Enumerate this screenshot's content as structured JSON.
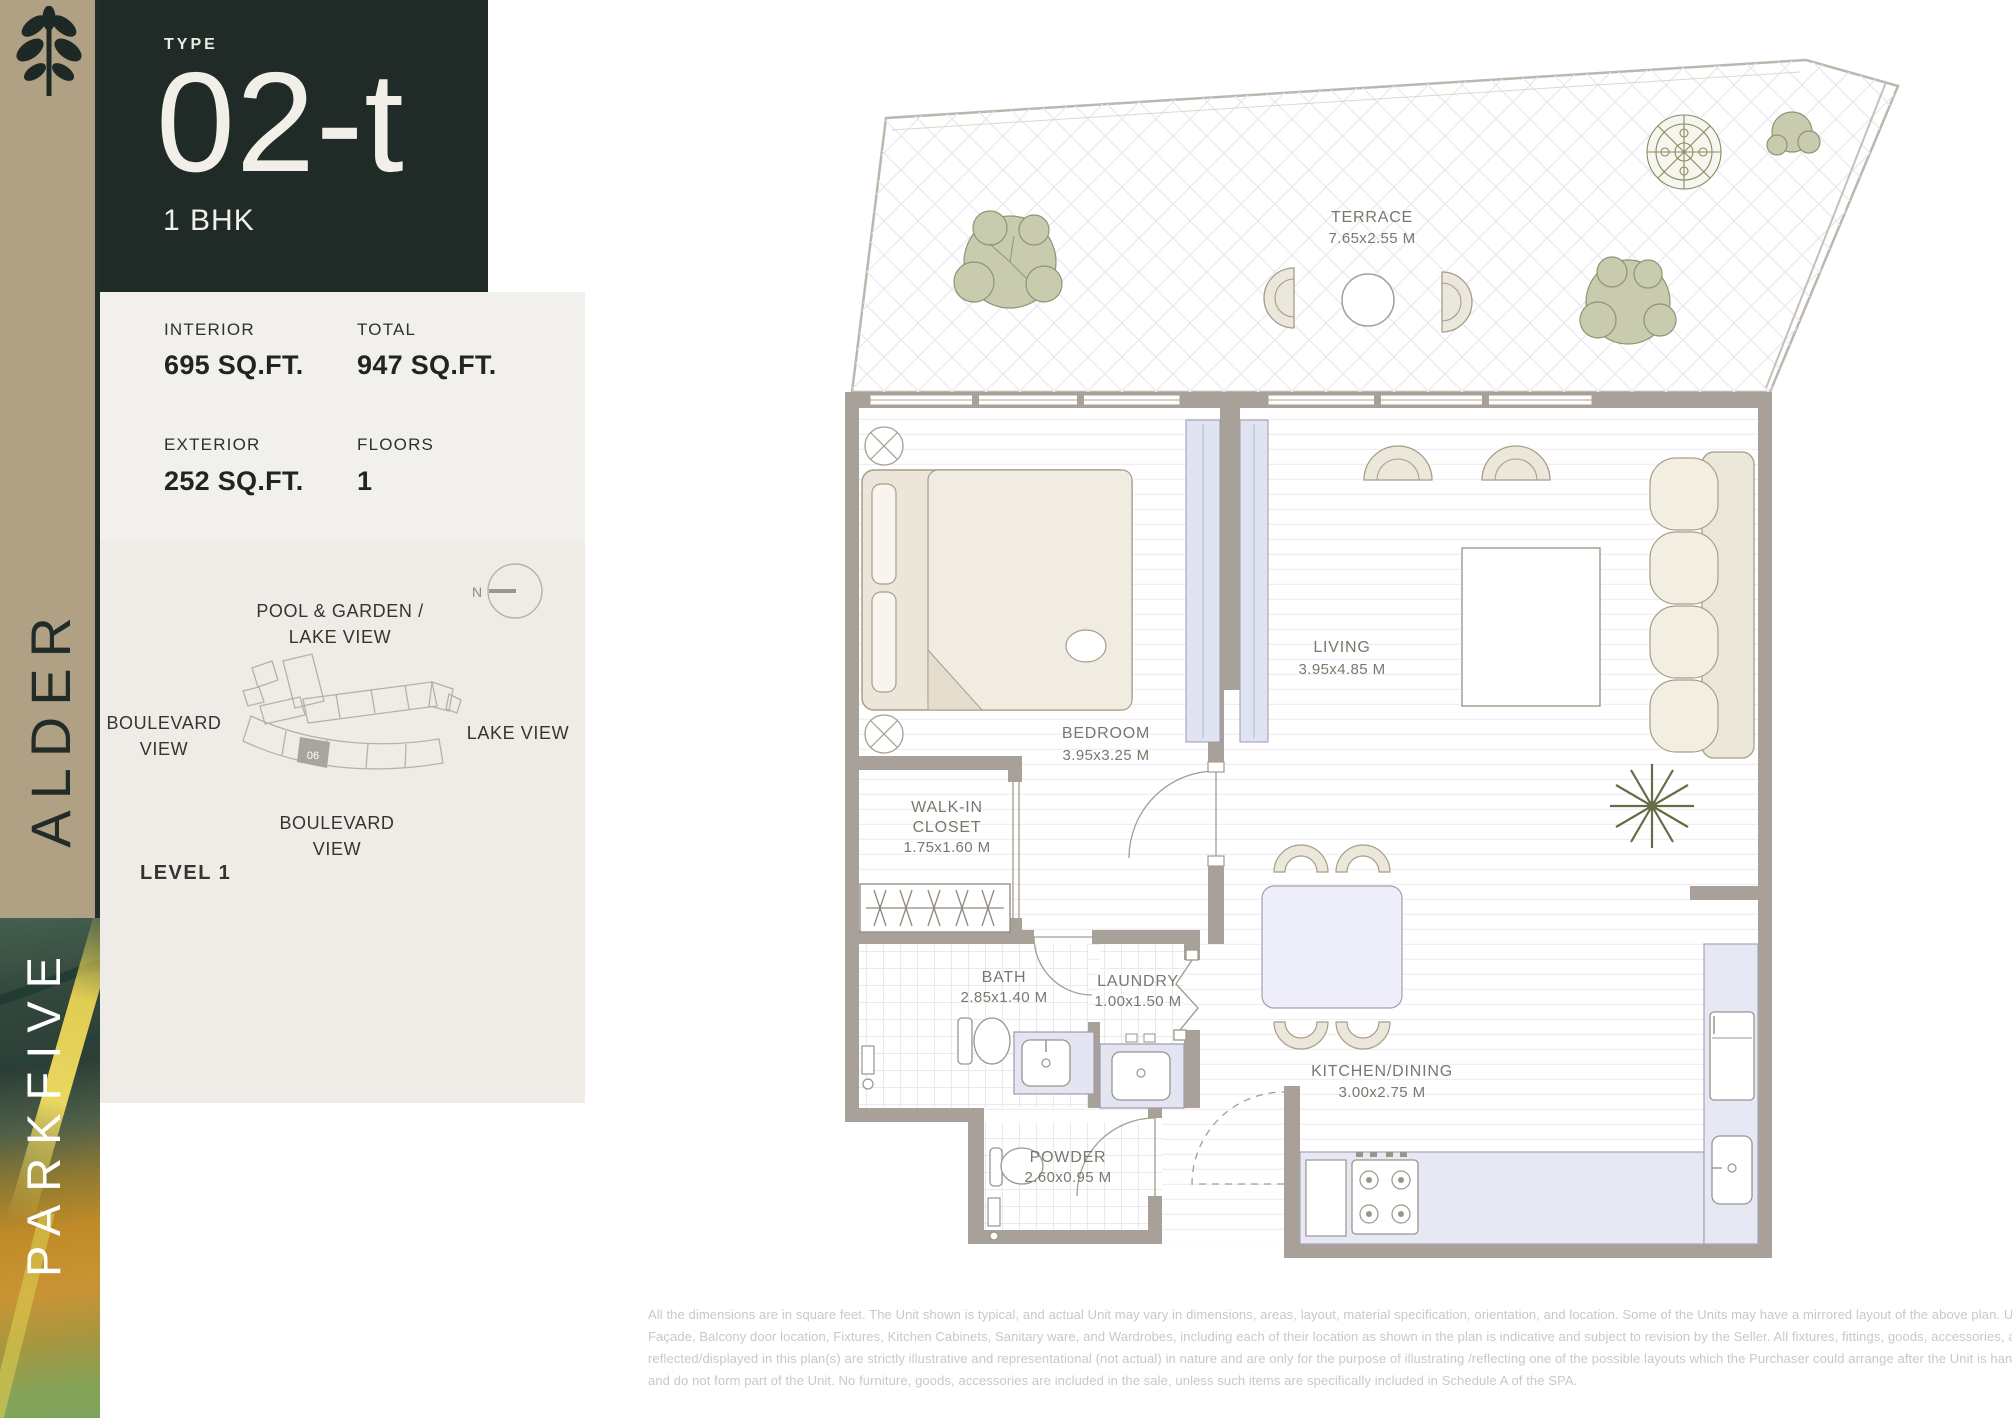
{
  "brand": {
    "building": "ALDER",
    "project": "PARKFIVE"
  },
  "header": {
    "type_label": "TYPE",
    "type_value": "02-t",
    "bhk": "1 BHK"
  },
  "stats": {
    "interior_label": "INTERIOR",
    "interior_value": "695 SQ.FT.",
    "total_label": "TOTAL",
    "total_value": "947 SQ.FT.",
    "exterior_label": "EXTERIOR",
    "exterior_value": "252 SQ.FT.",
    "floors_label": "FLOORS",
    "floors_value": "1"
  },
  "sitemap": {
    "compass": "N",
    "view_top_1": "POOL & GARDEN /",
    "view_top_2": "LAKE VIEW",
    "view_left_1": "BOULEVARD",
    "view_left_2": "VIEW",
    "view_right": "LAKE VIEW",
    "view_bottom_1": "BOULEVARD",
    "view_bottom_2": "VIEW",
    "unit_number": "06",
    "level": "LEVEL 1"
  },
  "rooms": {
    "terrace_name": "TERRACE",
    "terrace_dims": "7.65x2.55 M",
    "bedroom_name": "BEDROOM",
    "bedroom_dims": "3.95x3.25 M",
    "living_name": "LIVING",
    "living_dims": "3.95x4.85 M",
    "walkin_1": "WALK-IN",
    "walkin_2": "CLOSET",
    "walkin_dims": "1.75x1.60 M",
    "bath_name": "BATH",
    "bath_dims": "2.85x1.40 M",
    "laundry_name": "LAUNDRY",
    "laundry_dims": "1.00x1.50 M",
    "kitchen_name": "KITCHEN/DINING",
    "kitchen_dims": "3.00x2.75 M",
    "powder_name": "POWDER",
    "powder_dims": "2.60x0.95 M"
  },
  "disclaimer": {
    "line1": "All the dimensions are in square feet. The Unit shown is typical, and actual Unit may vary in dimensions, areas, layout, material specification, orientation, and location. Some of the Units may have a mirrored layout of the above plan. Unit Windows,",
    "line2": "Façade, Balcony door location, Fixtures, Kitchen Cabinets, Sanitary ware, and Wardrobes, including each of their location as shown in the plan is indicative and subject to revision by the Seller. All fixtures, fittings, goods, accessories, and furniture",
    "line3": "reflected/displayed in this plan(s) are strictly illustrative and representational (not actual) in nature and are only for the purpose of illustrating /reflecting one of the possible layouts which the Purchaser could arrange after the Unit is handed over",
    "line4": "and do not form part of the Unit. No furniture, goods, accessories are included in the sale, unless such items are specifically included in Schedule A of the SPA."
  },
  "colors": {
    "accent_tan": "#b1a184",
    "panel_dark": "#202b28",
    "cream_text": "#f2efe9",
    "wall_gray": "#a8a199",
    "fixture_lavender": "#e3e5f2",
    "olive_green": "#c9cbae",
    "label_gray": "#7b776c"
  }
}
